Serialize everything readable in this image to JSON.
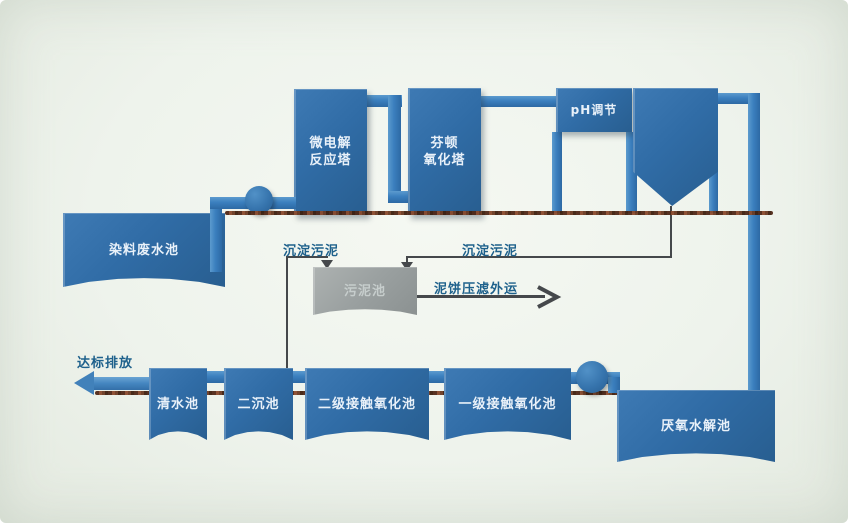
{
  "diagram": {
    "type": "wastewater-treatment-process-flow"
  },
  "colors": {
    "tank_blue": "#2f6ba4",
    "pipe_blue": "#3b7fbe",
    "sludge_gray": "#9aa0a0",
    "label_blue": "#1e618c",
    "ground_brown": "#6b3a26",
    "background": "#eef3ec",
    "tank_text": "#e9f1f9"
  },
  "nodes": {
    "dye_pool": {
      "label": "染料废水池"
    },
    "micro_tower": {
      "line1": "微电解",
      "line2": "反应塔"
    },
    "fenton_tower": {
      "line1": "芬顿",
      "line2": "氧化塔"
    },
    "ph_adjust": {
      "label": "pH调节"
    },
    "inclined_settler": {
      "label": "斜管沉淀池"
    },
    "sludge_pool": {
      "label": "污泥池"
    },
    "anaerobic_pool": {
      "label": "厌氧水解池"
    },
    "primary_oxidation": {
      "label": "一级接触氧化池"
    },
    "secondary_oxidation": {
      "label": "二级接触氧化池"
    },
    "secondary_settler": {
      "label": "二沉池"
    },
    "clean_pool": {
      "label": "清水池"
    }
  },
  "flow_labels": {
    "settled_sludge_left": "沉淀污泥",
    "settled_sludge_right": "沉淀污泥",
    "mudcake_out": "泥饼压滤外运",
    "discharge": "达标排放"
  }
}
